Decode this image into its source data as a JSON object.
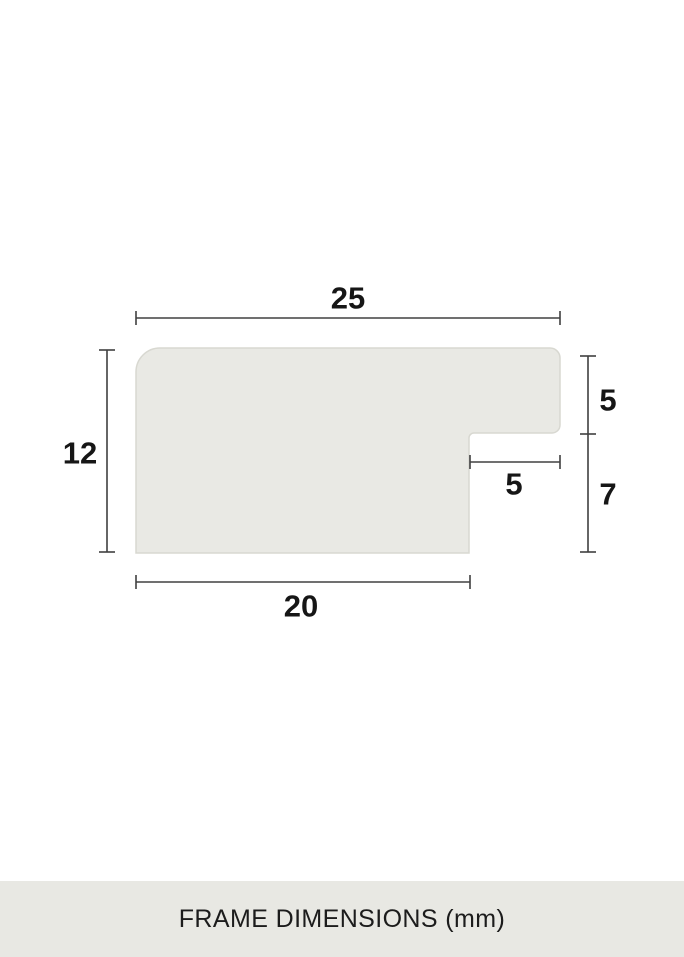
{
  "diagram": {
    "kind": "frame-profile-cross-section",
    "unit": "mm",
    "dimensions": {
      "top_width": "25",
      "left_height": "12",
      "right_upper_height": "5",
      "rabbet_width": "5",
      "right_lower_height": "7",
      "bottom_width": "20"
    }
  },
  "footer": {
    "title": "FRAME DIMENSIONS (mm)"
  },
  "colors": {
    "background": "#ffffff",
    "shape_fill": "#e9e9e4",
    "shape_stroke": "#d8d8d1",
    "dim_line": "#404040",
    "label_text": "#161616",
    "footer_bg": "#e8e8e3",
    "footer_text": "#1c1c1c"
  }
}
